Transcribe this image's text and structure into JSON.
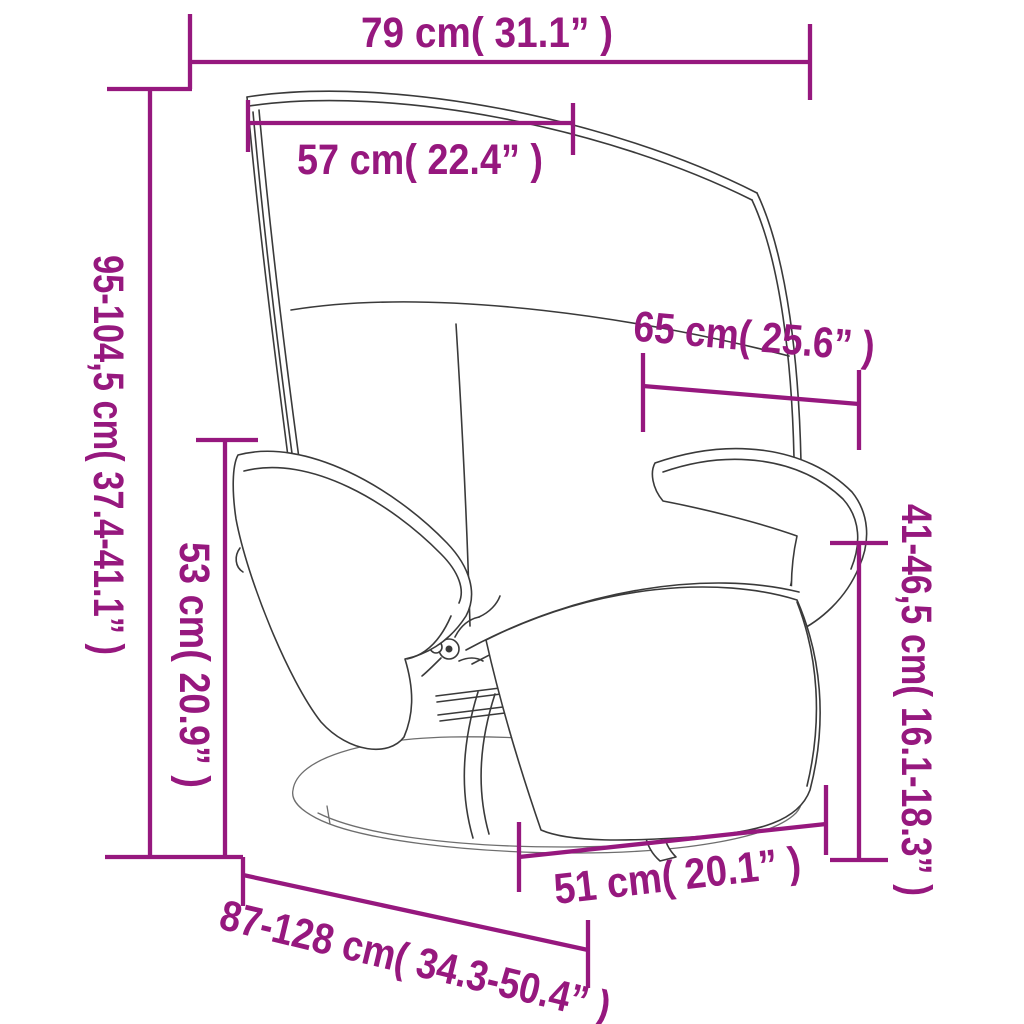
{
  "page": {
    "kind": "product dimension diagram",
    "subject": "recliner chair with footrest",
    "background": "#FFFFFF"
  },
  "colors": {
    "dimension": "#96187E",
    "line_art": "#3A3A3A",
    "base_line_art": "#6E6E6E"
  },
  "measurements": {
    "overall_width": "79 cm( 31.1” )",
    "headrest_width": "57 cm( 22.4” )",
    "overall_height": "95-104,5 cm( 37.4-41.1” )",
    "armrest_height": "53 cm( 20.9” )",
    "upper_depth": "65 cm( 25.6” )",
    "rear_height": "41-46,5 cm( 16.1-18.3” )",
    "base_width": "51 cm( 20.1” )",
    "reclined_length": "87-128 cm( 34.3-50.4” )"
  }
}
